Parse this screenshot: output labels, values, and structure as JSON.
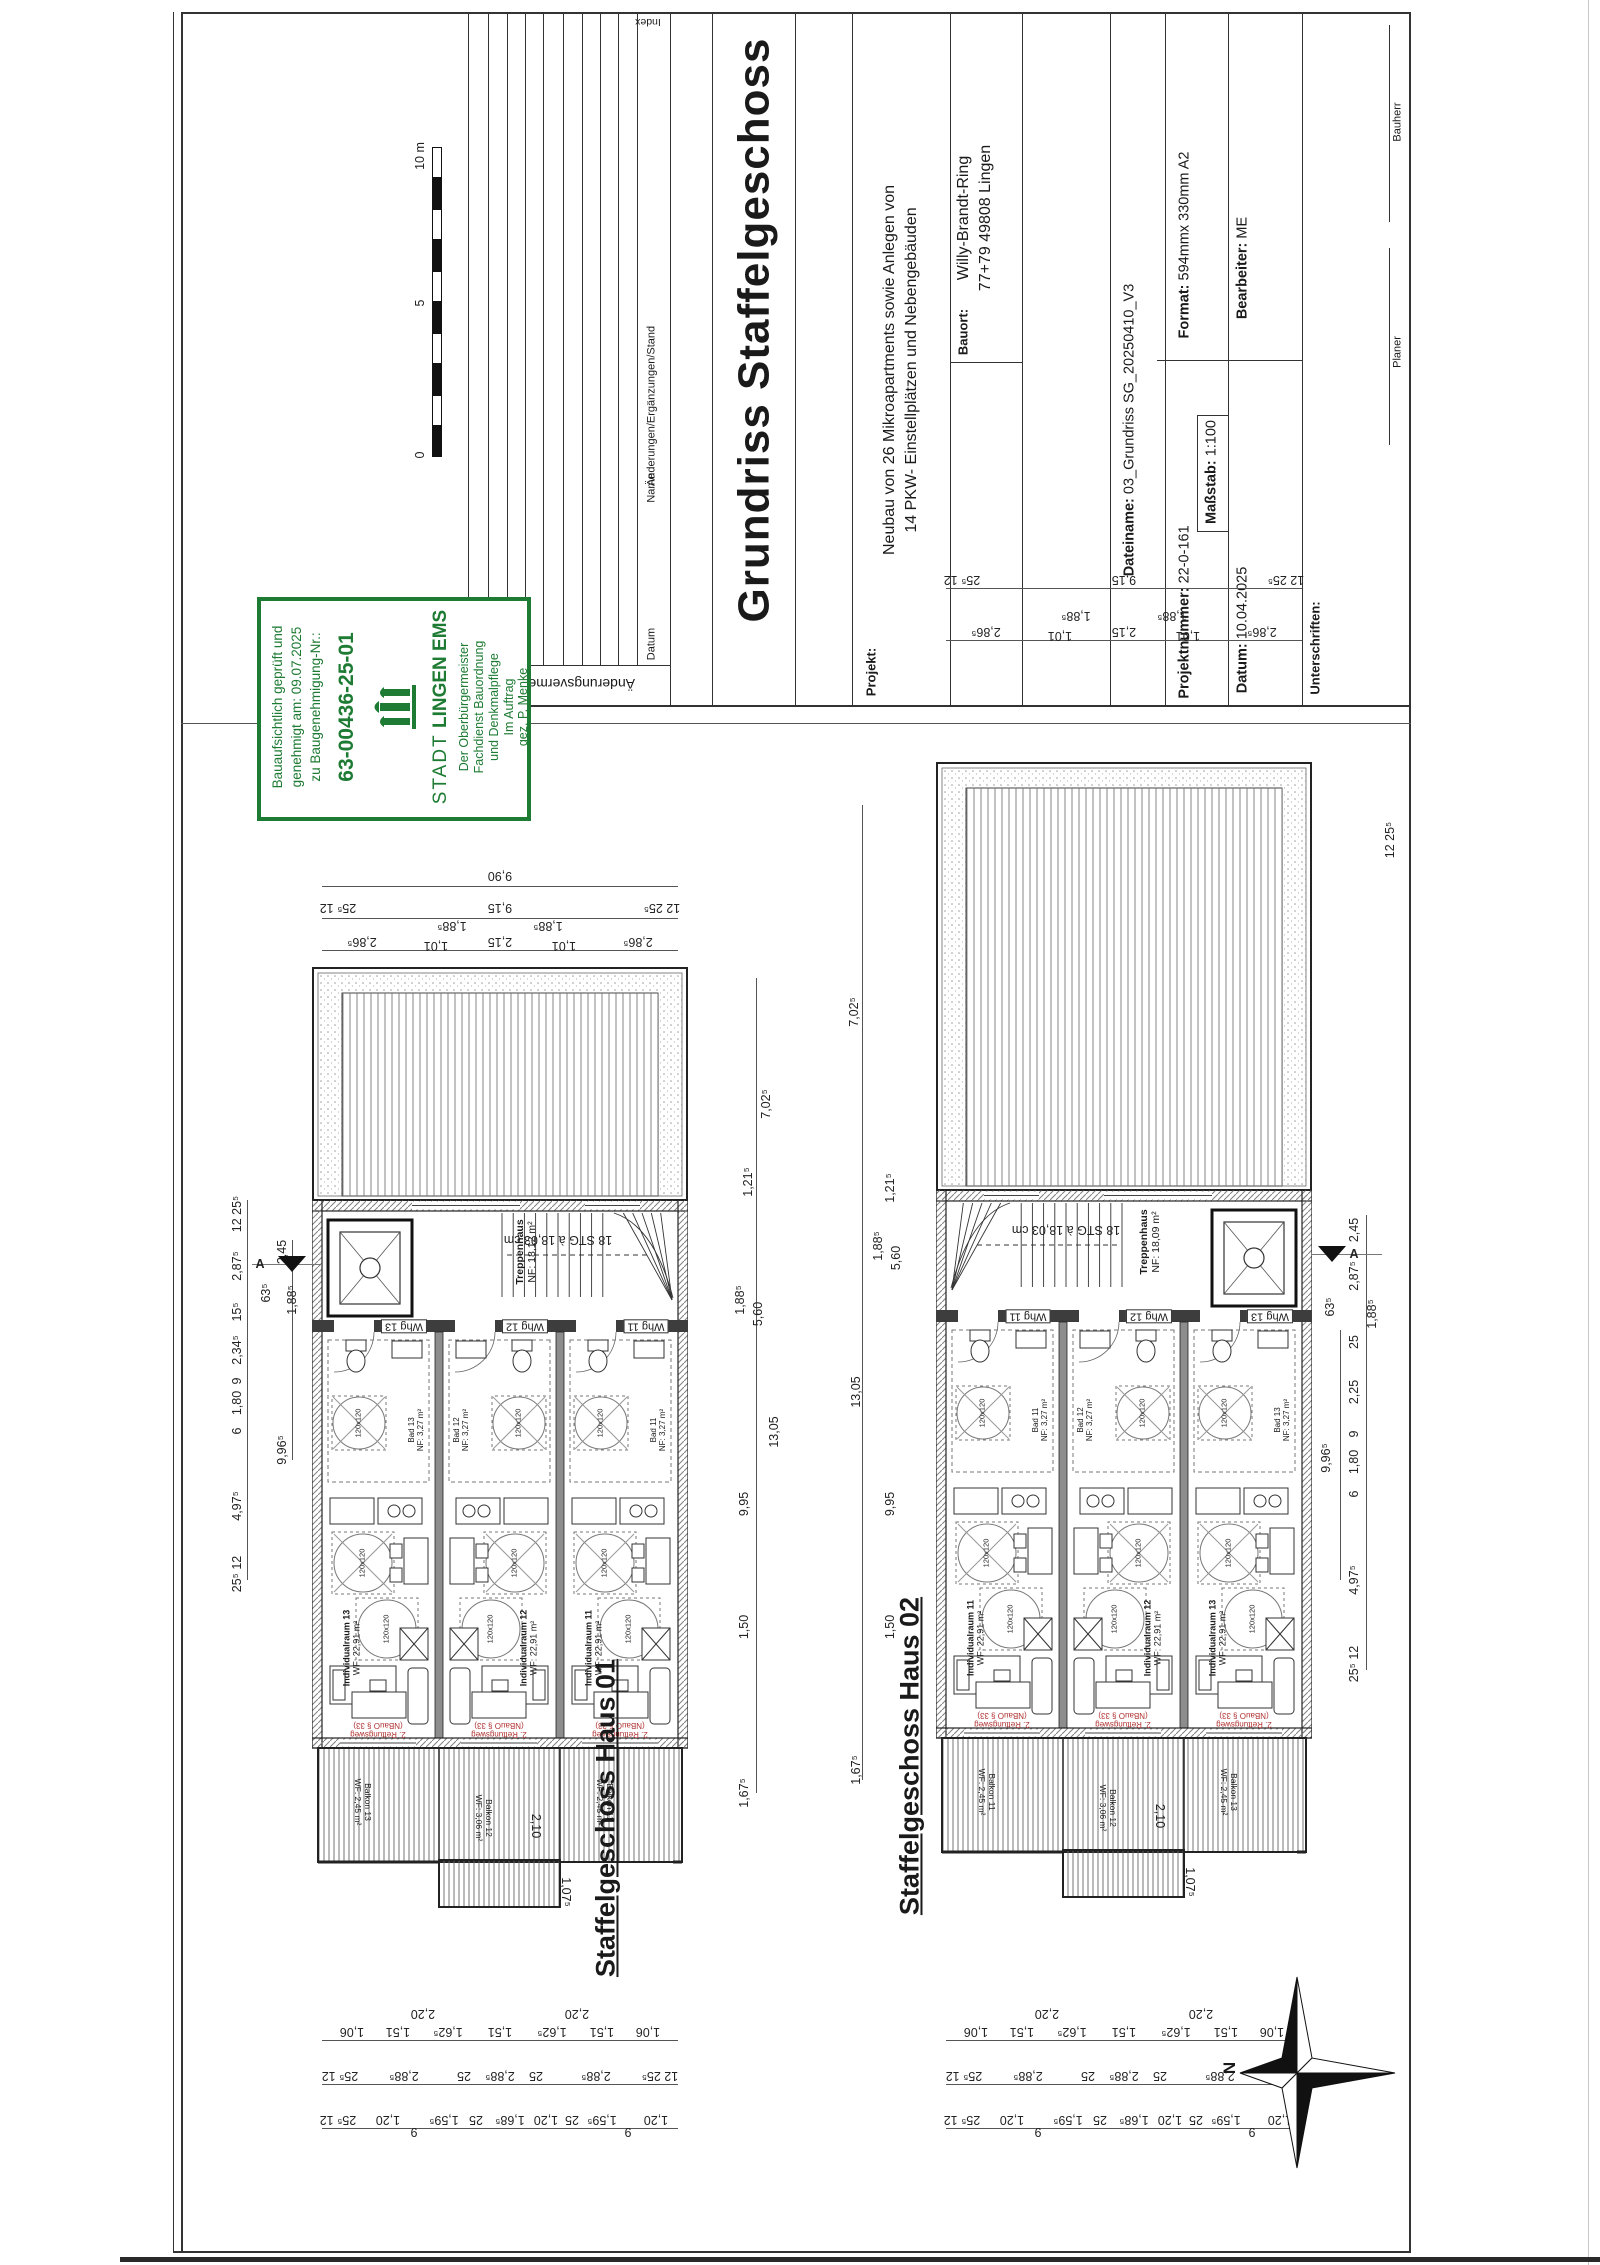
{
  "sheet": {
    "scalebar": {
      "zero": "0",
      "five": "5",
      "ten": "10 m"
    },
    "revisions": {
      "title": "Änderungsvermerke",
      "col_datum": "Datum",
      "col_name": "Name",
      "col_changes": "Änderungen/Ergänzungen/Stand",
      "col_index": "Index"
    },
    "titleblock": {
      "title": "Grundriss Staffelgeschoss",
      "projekt_label": "Projekt:",
      "projekt_line1": "Neubau von 26 Mikroapartments sowie Anlegen von",
      "projekt_line2": "14 PKW- Einstellplätzen und Nebengebäuden",
      "bauort_label": "Bauort:",
      "bauort_line1": "Willy-Brandt-Ring",
      "bauort_line2": "77+79 49808 Lingen",
      "dateiname_label": "Dateiname:",
      "dateiname": "03_Grundriss SG_20250410_V3",
      "projektnummer_label": "Projektnummer:",
      "projektnummer": "22-0-161",
      "massstab_label": "Maßstab:",
      "massstab": "1:100",
      "datum_label": "Datum:",
      "datum": "10.04.2025",
      "format_label": "Format:",
      "format": "594mmx 330mm A2",
      "bearbeiter_label": "Bearbeiter:",
      "bearbeiter": "ME",
      "unterschriften_label": "Unterschriften:",
      "sig_planer": "Planer",
      "sig_bauherr": "Bauherr"
    },
    "approval_stamp": {
      "line1": "Bauaufsichtlich geprüft und",
      "line2": "genehmigt am: 09.07.2025",
      "line3": "zu Baugenehmigung-Nr.:",
      "number": "63-00436-25-01",
      "city_prefix": "STADT",
      "city_name": "LINGEN EMS",
      "dept1": "Der Oberbürgermeister",
      "dept2": "Fachdienst Bauordnung",
      "dept3": "und Denkmalpflege",
      "dept4": "Im Auftrag",
      "dept5": "gez. P. Menke",
      "green": "#1e7b33"
    },
    "north_label": "N"
  },
  "plans": {
    "haus1": {
      "caption": "Staffelgeschoss Haus 01",
      "stairwell": "Treppenhaus",
      "stairwell_area": "NF: 18,12 m²",
      "stair_note": "18 STG à 18,03 cm",
      "section_letter": "A",
      "rescue_line1": "2. Rettungsweg",
      "rescue_line2": "(NBauO § 33)",
      "clearance": "120x120",
      "units": [
        {
          "tag": "Whg 13",
          "bad": "Bad 13",
          "bad_area": "NF: 3,27 m²",
          "room": "Individualraum 13",
          "room_area": "WF: 22,91 m²",
          "balcony": "Balkon 13",
          "balcony_area": "WF: 2,45 m²"
        },
        {
          "tag": "Whg 12",
          "bad": "Bad 12",
          "bad_area": "NF: 3,27 m²",
          "room": "Individualraum 12",
          "room_area": "WF: 22,91 m²",
          "balcony": "Balkon 12",
          "balcony_area": "WF: 3,06 m²"
        },
        {
          "tag": "Whg 11",
          "bad": "Bad 11",
          "bad_area": "NF: 3,27 m²",
          "room": "Individualraum 11",
          "room_area": "WF: 22,91 m²",
          "balcony": "Balkon 11",
          "balcony_area": "WF: 2,45 m²"
        }
      ]
    },
    "haus2": {
      "caption": "Staffelgeschoss Haus 02",
      "stairwell": "Treppenhaus",
      "stairwell_area": "NF: 18,09 m²",
      "stair_note": "18 STG à 18,03 cm",
      "section_letter": "A",
      "rescue_line1": "2. Rettungsweg",
      "rescue_line2": "(NBauO § 33)",
      "clearance": "120x120",
      "units": [
        {
          "tag": "Whg 11",
          "bad": "Bad 11",
          "bad_area": "NF: 3,27 m²",
          "room": "Individualraum 11",
          "room_area": "WF: 22,91 m²",
          "balcony": "Balkon 11",
          "balcony_area": "WF: 2,45 m²"
        },
        {
          "tag": "Whg 12",
          "bad": "Bad 12",
          "bad_area": "NF: 3,27 m²",
          "room": "Individualraum 12",
          "room_area": "WF: 22,91 m²",
          "balcony": "Balkon 12",
          "balcony_area": "WF: 3,06 m²"
        },
        {
          "tag": "Whg 13",
          "bad": "Bad 13",
          "bad_area": "NF: 3,27 m²",
          "room": "Individualraum 13",
          "room_area": "WF: 22,91 m²",
          "balcony": "Balkon 13",
          "balcony_area": "WF: 2,45 m²"
        }
      ]
    }
  },
  "dims": [
    {
      "t": "9,90",
      "x": 500,
      "y": 876,
      "r": "u"
    },
    {
      "t": "25⁵ 12",
      "x": 338,
      "y": 908,
      "r": "u"
    },
    {
      "t": "9,15",
      "x": 500,
      "y": 908,
      "r": "u"
    },
    {
      "t": "12 25⁵",
      "x": 662,
      "y": 908,
      "r": "u"
    },
    {
      "t": "2,86⁵",
      "x": 362,
      "y": 942,
      "r": "u"
    },
    {
      "t": "1,01",
      "x": 436,
      "y": 946,
      "r": "u"
    },
    {
      "t": "1,88⁵",
      "x": 452,
      "y": 926,
      "r": "u"
    },
    {
      "t": "2,15",
      "x": 500,
      "y": 942,
      "r": "u"
    },
    {
      "t": "1,88⁵",
      "x": 548,
      "y": 926,
      "r": "u"
    },
    {
      "t": "1,01",
      "x": 564,
      "y": 946,
      "r": "u"
    },
    {
      "t": "2,86⁵",
      "x": 638,
      "y": 942,
      "r": "u"
    },
    {
      "t": "12 25⁵",
      "x": 237,
      "y": 1214,
      "r": "v"
    },
    {
      "t": "2,45",
      "x": 282,
      "y": 1252,
      "r": "v"
    },
    {
      "t": "2,87⁵",
      "x": 237,
      "y": 1266,
      "r": "v"
    },
    {
      "t": "63⁵",
      "x": 266,
      "y": 1293,
      "r": "v"
    },
    {
      "t": "1,88⁵",
      "x": 292,
      "y": 1300,
      "r": "v"
    },
    {
      "t": "15⁵",
      "x": 237,
      "y": 1312,
      "r": "v"
    },
    {
      "t": "2,34⁵",
      "x": 237,
      "y": 1350,
      "r": "v"
    },
    {
      "t": "9",
      "x": 237,
      "y": 1381,
      "r": "v"
    },
    {
      "t": "1,80",
      "x": 237,
      "y": 1403,
      "r": "v"
    },
    {
      "t": "6",
      "x": 237,
      "y": 1431,
      "r": "v"
    },
    {
      "t": "9,96⁵",
      "x": 282,
      "y": 1450,
      "r": "v"
    },
    {
      "t": "4,97⁵",
      "x": 237,
      "y": 1506,
      "r": "v"
    },
    {
      "t": "25⁵ 12",
      "x": 237,
      "y": 1574,
      "r": "v"
    },
    {
      "t": "7,02⁵",
      "x": 766,
      "y": 1104,
      "r": "v"
    },
    {
      "t": "1,21⁵",
      "x": 748,
      "y": 1182,
      "r": "v"
    },
    {
      "t": "1,88⁵",
      "x": 740,
      "y": 1300,
      "r": "v"
    },
    {
      "t": "5,60",
      "x": 758,
      "y": 1314,
      "r": "v"
    },
    {
      "t": "13,05",
      "x": 774,
      "y": 1432,
      "r": "v"
    },
    {
      "t": "9,95",
      "x": 744,
      "y": 1504,
      "r": "v"
    },
    {
      "t": "1,50",
      "x": 744,
      "y": 1627,
      "r": "v"
    },
    {
      "t": "1,67⁵",
      "x": 744,
      "y": 1793,
      "r": "v"
    },
    {
      "t": "7,02⁵",
      "x": 854,
      "y": 1012,
      "r": "v"
    },
    {
      "t": "1,21⁵",
      "x": 890,
      "y": 1188,
      "r": "v"
    },
    {
      "t": "1,88⁵",
      "x": 878,
      "y": 1246,
      "r": "v"
    },
    {
      "t": "5,60",
      "x": 896,
      "y": 1258,
      "r": "v"
    },
    {
      "t": "13,05",
      "x": 856,
      "y": 1392,
      "r": "v"
    },
    {
      "t": "9,95",
      "x": 890,
      "y": 1504,
      "r": "v"
    },
    {
      "t": "1,50",
      "x": 890,
      "y": 1627,
      "r": "v"
    },
    {
      "t": "1,67⁵",
      "x": 856,
      "y": 1770,
      "r": "v"
    },
    {
      "t": "25⁵ 12",
      "x": 962,
      "y": 580,
      "r": "u"
    },
    {
      "t": "9,15",
      "x": 1124,
      "y": 580,
      "r": "u"
    },
    {
      "t": "12 25⁵",
      "x": 1286,
      "y": 580,
      "r": "u"
    },
    {
      "t": "2,86⁵",
      "x": 986,
      "y": 632,
      "r": "u"
    },
    {
      "t": "1,01",
      "x": 1060,
      "y": 636,
      "r": "u"
    },
    {
      "t": "1,88⁵",
      "x": 1076,
      "y": 616,
      "r": "u"
    },
    {
      "t": "2,15",
      "x": 1124,
      "y": 632,
      "r": "u"
    },
    {
      "t": "1,88⁵",
      "x": 1172,
      "y": 616,
      "r": "u"
    },
    {
      "t": "1,01",
      "x": 1188,
      "y": 636,
      "r": "u"
    },
    {
      "t": "2,86⁵",
      "x": 1262,
      "y": 632,
      "r": "u"
    },
    {
      "t": "12 25⁵",
      "x": 1390,
      "y": 840,
      "r": "v"
    },
    {
      "t": "2,45",
      "x": 1354,
      "y": 1230,
      "r": "v"
    },
    {
      "t": "2,87⁵",
      "x": 1354,
      "y": 1276,
      "r": "v"
    },
    {
      "t": "63⁵",
      "x": 1330,
      "y": 1307,
      "r": "v"
    },
    {
      "t": "1,88⁵",
      "x": 1372,
      "y": 1314,
      "r": "v"
    },
    {
      "t": "25",
      "x": 1354,
      "y": 1342,
      "r": "v"
    },
    {
      "t": "2,25",
      "x": 1354,
      "y": 1392,
      "r": "v"
    },
    {
      "t": "9",
      "x": 1354,
      "y": 1434,
      "r": "v"
    },
    {
      "t": "1,80",
      "x": 1354,
      "y": 1462,
      "r": "v"
    },
    {
      "t": "6",
      "x": 1354,
      "y": 1494,
      "r": "v"
    },
    {
      "t": "9,96⁵",
      "x": 1326,
      "y": 1458,
      "r": "v"
    },
    {
      "t": "4,97⁵",
      "x": 1354,
      "y": 1580,
      "r": "v"
    },
    {
      "t": "25⁵ 12",
      "x": 1354,
      "y": 1664,
      "r": "v"
    },
    {
      "t": "2,10",
      "x": 536,
      "y": 1826,
      "r": "w"
    },
    {
      "t": "1,07⁵",
      "x": 566,
      "y": 1892,
      "r": "w"
    },
    {
      "t": "2,10",
      "x": 1160,
      "y": 1816,
      "r": "w"
    },
    {
      "t": "1,07⁵",
      "x": 1190,
      "y": 1882,
      "r": "w"
    },
    {
      "t": "1,06",
      "x": 352,
      "y": 2032,
      "r": "u"
    },
    {
      "t": "1,51",
      "x": 398,
      "y": 2032,
      "r": "u"
    },
    {
      "t": "1,62⁵",
      "x": 448,
      "y": 2032,
      "r": "u"
    },
    {
      "t": "1,51",
      "x": 500,
      "y": 2032,
      "r": "u"
    },
    {
      "t": "1,62⁵",
      "x": 552,
      "y": 2032,
      "r": "u"
    },
    {
      "t": "1,51",
      "x": 602,
      "y": 2032,
      "r": "u"
    },
    {
      "t": "1,06",
      "x": 648,
      "y": 2032,
      "r": "u"
    },
    {
      "t": "2,20",
      "x": 423,
      "y": 2014,
      "r": "u"
    },
    {
      "t": "2,20",
      "x": 577,
      "y": 2014,
      "r": "u"
    },
    {
      "t": "25⁵ 12",
      "x": 340,
      "y": 2076,
      "r": "u"
    },
    {
      "t": "2,88⁵",
      "x": 404,
      "y": 2076,
      "r": "u"
    },
    {
      "t": "25",
      "x": 464,
      "y": 2076,
      "r": "u"
    },
    {
      "t": "2,88⁵",
      "x": 500,
      "y": 2076,
      "r": "u"
    },
    {
      "t": "25",
      "x": 536,
      "y": 2076,
      "r": "u"
    },
    {
      "t": "2,88⁵",
      "x": 596,
      "y": 2076,
      "r": "u"
    },
    {
      "t": "12 25⁵",
      "x": 660,
      "y": 2076,
      "r": "u"
    },
    {
      "t": "25⁵ 12",
      "x": 338,
      "y": 2120,
      "r": "u"
    },
    {
      "t": "1,20",
      "x": 388,
      "y": 2120,
      "r": "u"
    },
    {
      "t": "9",
      "x": 414,
      "y": 2132,
      "r": "u"
    },
    {
      "t": "1,59⁵",
      "x": 444,
      "y": 2120,
      "r": "u"
    },
    {
      "t": "25",
      "x": 476,
      "y": 2120,
      "r": "u"
    },
    {
      "t": "1,68⁵",
      "x": 510,
      "y": 2120,
      "r": "u"
    },
    {
      "t": "1,20",
      "x": 546,
      "y": 2120,
      "r": "u"
    },
    {
      "t": "25",
      "x": 572,
      "y": 2120,
      "r": "u"
    },
    {
      "t": "1,59⁵",
      "x": 602,
      "y": 2120,
      "r": "u"
    },
    {
      "t": "9",
      "x": 628,
      "y": 2132,
      "r": "u"
    },
    {
      "t": "1,20",
      "x": 656,
      "y": 2120,
      "r": "u"
    },
    {
      "t": "1,06",
      "x": 976,
      "y": 2032,
      "r": "u"
    },
    {
      "t": "1,51",
      "x": 1022,
      "y": 2032,
      "r": "u"
    },
    {
      "t": "1,62⁵",
      "x": 1072,
      "y": 2032,
      "r": "u"
    },
    {
      "t": "1,51",
      "x": 1124,
      "y": 2032,
      "r": "u"
    },
    {
      "t": "1,62⁵",
      "x": 1176,
      "y": 2032,
      "r": "u"
    },
    {
      "t": "1,51",
      "x": 1226,
      "y": 2032,
      "r": "u"
    },
    {
      "t": "1,06",
      "x": 1272,
      "y": 2032,
      "r": "u"
    },
    {
      "t": "2,20",
      "x": 1047,
      "y": 2014,
      "r": "u"
    },
    {
      "t": "2,20",
      "x": 1201,
      "y": 2014,
      "r": "u"
    },
    {
      "t": "25⁵ 12",
      "x": 964,
      "y": 2076,
      "r": "u"
    },
    {
      "t": "2,88⁵",
      "x": 1028,
      "y": 2076,
      "r": "u"
    },
    {
      "t": "25",
      "x": 1088,
      "y": 2076,
      "r": "u"
    },
    {
      "t": "2,88⁵",
      "x": 1124,
      "y": 2076,
      "r": "u"
    },
    {
      "t": "25",
      "x": 1160,
      "y": 2076,
      "r": "u"
    },
    {
      "t": "2,88⁵",
      "x": 1220,
      "y": 2076,
      "r": "u"
    },
    {
      "t": "12 25⁵",
      "x": 1284,
      "y": 2076,
      "r": "u"
    },
    {
      "t": "25⁵ 12",
      "x": 962,
      "y": 2120,
      "r": "u"
    },
    {
      "t": "1,20",
      "x": 1012,
      "y": 2120,
      "r": "u"
    },
    {
      "t": "9",
      "x": 1038,
      "y": 2132,
      "r": "u"
    },
    {
      "t": "1,59⁵",
      "x": 1068,
      "y": 2120,
      "r": "u"
    },
    {
      "t": "25",
      "x": 1100,
      "y": 2120,
      "r": "u"
    },
    {
      "t": "1,68⁵",
      "x": 1134,
      "y": 2120,
      "r": "u"
    },
    {
      "t": "1,20",
      "x": 1170,
      "y": 2120,
      "r": "u"
    },
    {
      "t": "25",
      "x": 1196,
      "y": 2120,
      "r": "u"
    },
    {
      "t": "1,59⁵",
      "x": 1226,
      "y": 2120,
      "r": "u"
    },
    {
      "t": "9",
      "x": 1252,
      "y": 2132,
      "r": "u"
    },
    {
      "t": "1,20",
      "x": 1280,
      "y": 2120,
      "r": "u"
    }
  ]
}
